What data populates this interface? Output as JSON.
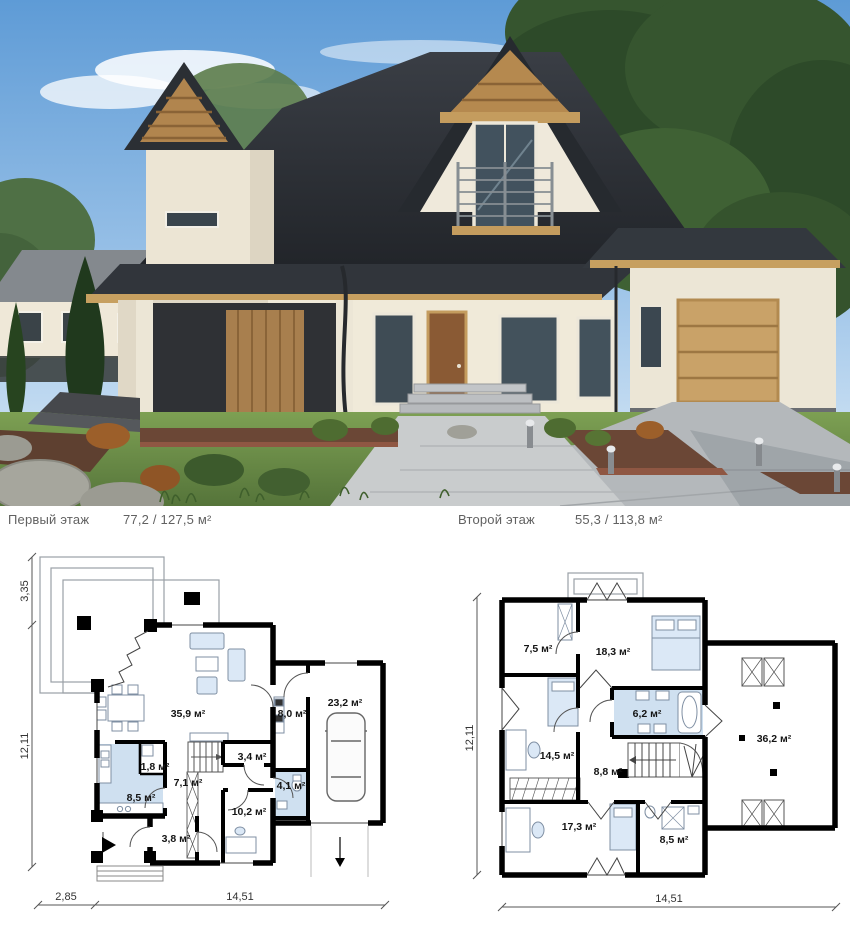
{
  "captions": {
    "first": {
      "label": "Первый этаж",
      "area": "77,2 / 127,5 м²"
    },
    "second": {
      "label": "Второй этаж",
      "area": "55,3 / 113,8 м²"
    }
  },
  "floor1": {
    "rooms": {
      "living": "35,9 м²",
      "vestibule": "8,0 м²",
      "garage": "23,2 м²",
      "pantry": "1,8 м²",
      "closet": "3,4 м²",
      "hall": "7,1 м²",
      "bath": "4,1 м²",
      "kitchen": "8,5 м²",
      "room": "10,2 м²",
      "entry": "3,8 м²"
    },
    "dims": {
      "terrace": "3,35",
      "depth": "12,11",
      "porch": "2,85",
      "width": "14,51"
    }
  },
  "floor2": {
    "rooms": {
      "wardrobe": "7,5 м²",
      "bedroom1": "18,3 м²",
      "bath": "6,2 м²",
      "bedroom2": "14,5 м²",
      "hall": "8,8 м²",
      "storage": "36,2 м²",
      "bedroom3": "17,3 м²",
      "bath2": "8,5 м²"
    },
    "dims": {
      "depth": "12,11",
      "width": "14,51"
    }
  },
  "colors": {
    "plan_wall": "#000000",
    "plan_wet_room_fill": "#cfe0f0",
    "plan_furniture_fill": "#dbe8f6",
    "caption_text": "#616161",
    "sky": "#5e9bd6",
    "roof": "#2e3136",
    "house_wall": "#f0ead9",
    "wood_trim": "#c49c5e",
    "garage_door": "#c9a268",
    "lawn": "#6c8c43",
    "driveway": "#b4b8bb",
    "mulch_bed": "#6b4736"
  }
}
